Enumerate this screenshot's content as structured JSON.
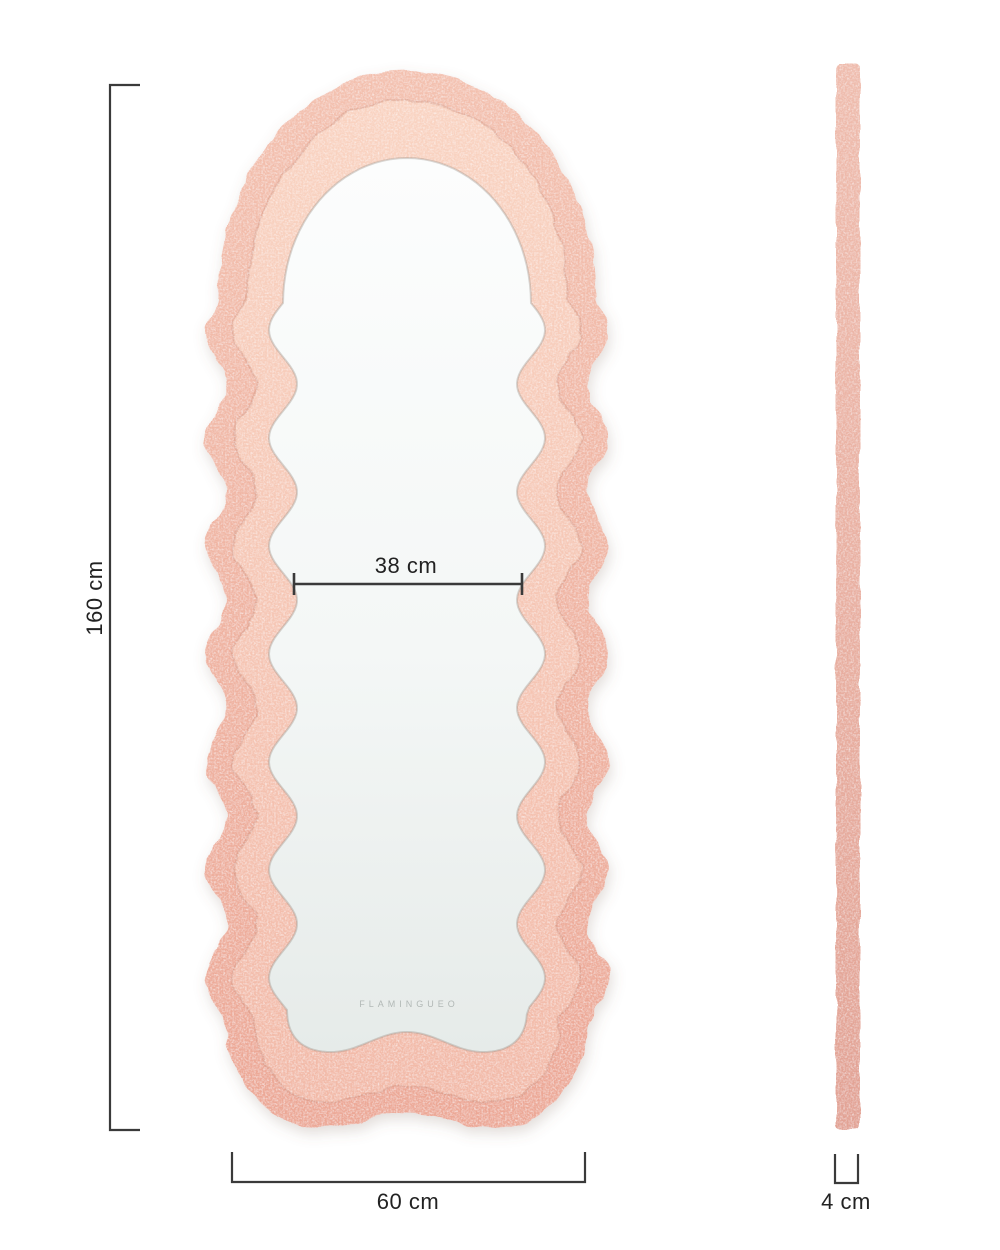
{
  "product": {
    "brand_watermark": "FLAMINGUEO"
  },
  "dimensions": {
    "height": "160 cm",
    "inner_width": "38 cm",
    "outer_width": "60 cm",
    "depth": "4 cm"
  },
  "colors": {
    "frame_outer_top": "#f3c0ae",
    "frame_outer_bottom": "#eca795",
    "frame_inner_top": "#f9d3c1",
    "frame_inner_bottom": "#f2b9a7",
    "glass_top": "#fcfdfd",
    "glass_mid": "#f4f7f6",
    "glass_bottom": "#e6ebe9",
    "side_top": "#efbcad",
    "side_bottom": "#e2a294",
    "dimension_line": "#3a3a3a",
    "label_text": "#222222",
    "watermark_text": "#b2b8b6"
  }
}
